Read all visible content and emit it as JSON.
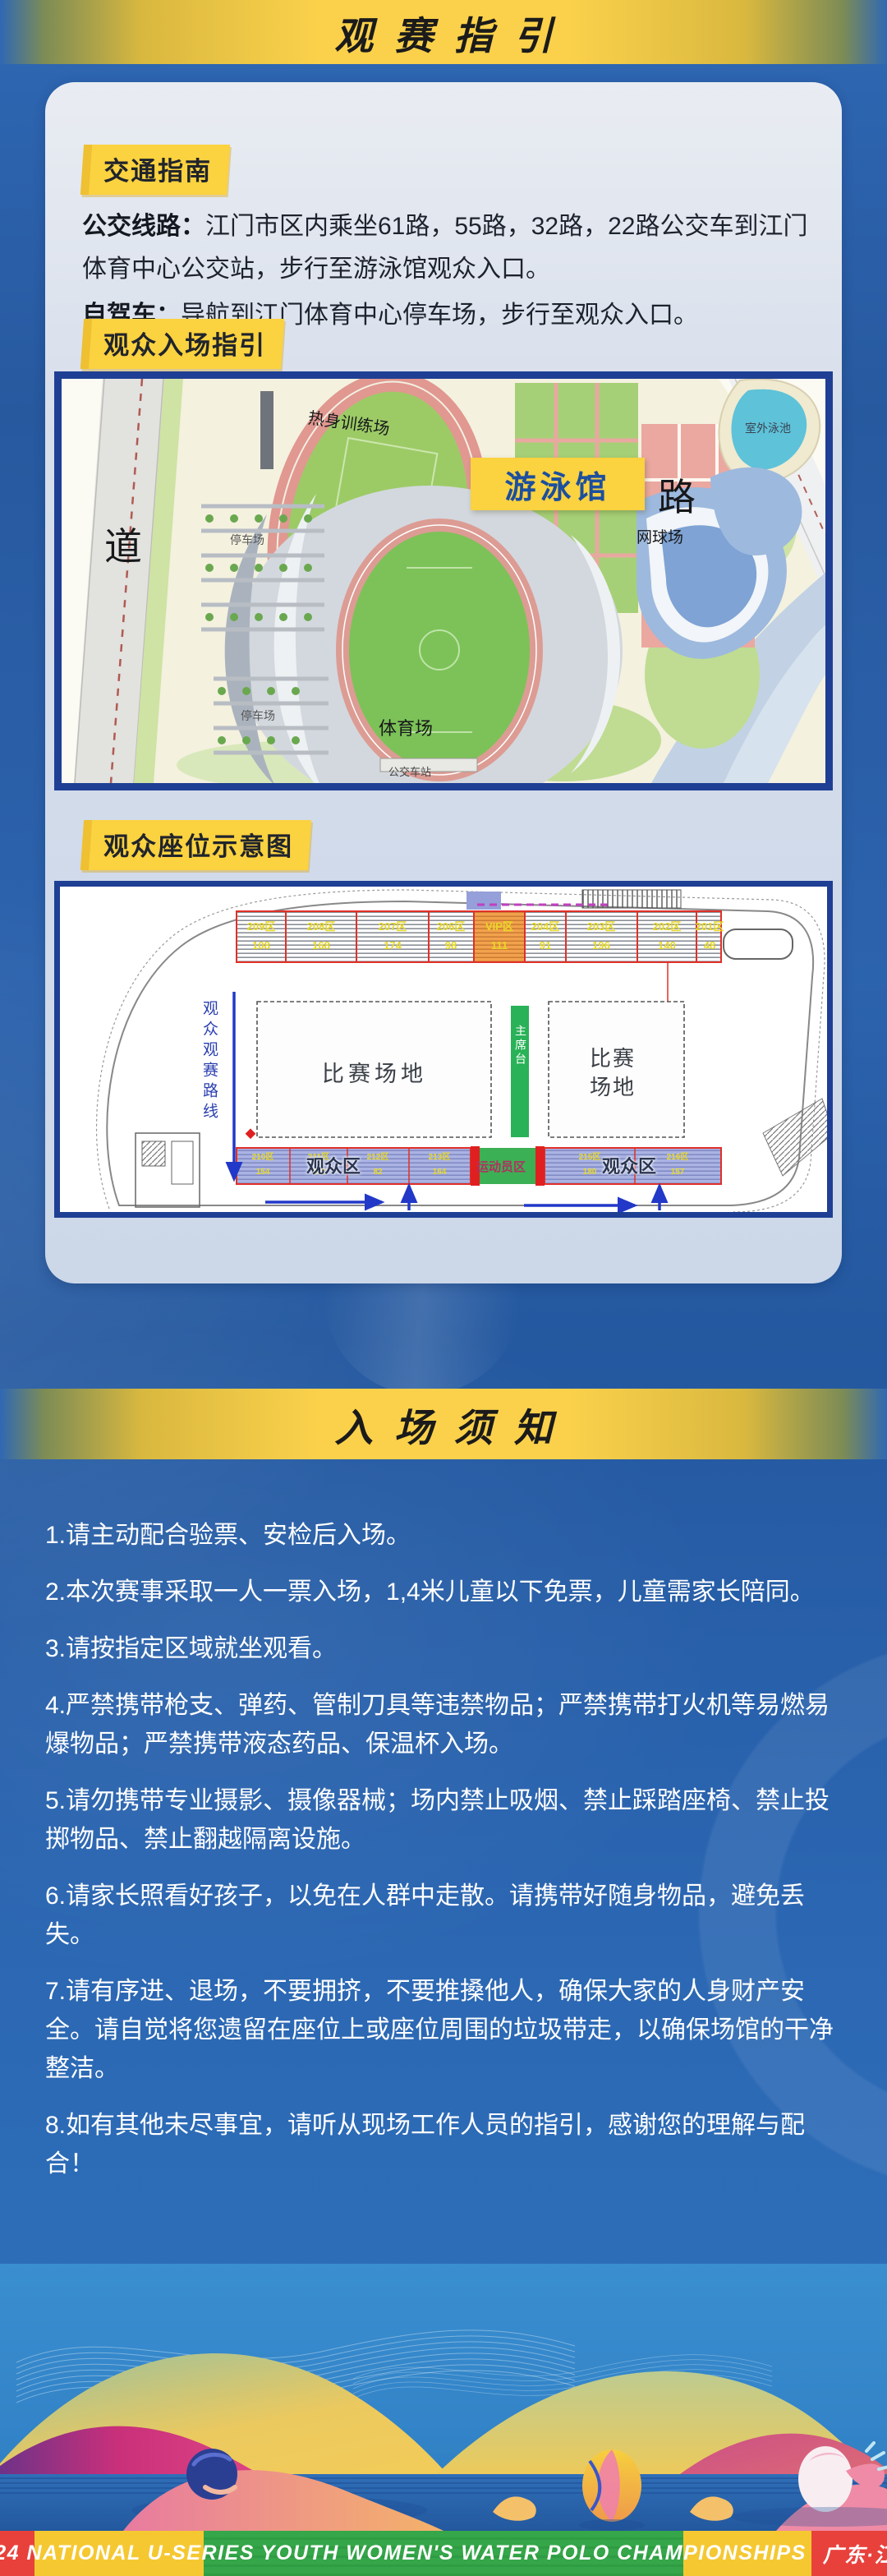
{
  "banner1": {
    "title": "观赛指引"
  },
  "banner2": {
    "title": "入场须知"
  },
  "guide": {
    "traffic_label": "交通指南",
    "bus_label": "公交线路：",
    "bus_text": "江门市区内乘坐61路，55路，32路，22路公交车到江门体育中心公交站，步行至游泳馆观众入口。",
    "drive_label": "自驾车：",
    "drive_text": "导航到江门体育中心停车场，步行至观众入口。",
    "entrance_label": "观众入场指引",
    "seating_label": "观众座位示意图"
  },
  "map": {
    "road_left": "道",
    "road_right": "路",
    "warmup_field": "热身训练场",
    "basketball": "篮球场",
    "tennis": "网球场",
    "outdoor_pool": "室外泳池",
    "natatorium": "游泳馆",
    "stadium": "体育场",
    "parking1": "停车场",
    "parking2": "停车场",
    "bus_station": "公交车站"
  },
  "seating": {
    "route_label": "观众观赛路线",
    "field_label_left": "比赛场地",
    "field_label_right": "比赛场地",
    "rostrum_label": "主席台",
    "audience_left": "观众区",
    "audience_right": "观众区",
    "athlete_label": "运动员区",
    "top_sections": [
      {
        "name": "209区",
        "count": "108"
      },
      {
        "name": "208区",
        "count": "168"
      },
      {
        "name": "207区",
        "count": "174"
      },
      {
        "name": "206区",
        "count": "98"
      },
      {
        "name": "VIP区",
        "count": "111"
      },
      {
        "name": "204区",
        "count": "91"
      },
      {
        "name": "203区",
        "count": "196"
      },
      {
        "name": "202区",
        "count": "140"
      },
      {
        "name": "201区",
        "count": "48"
      }
    ],
    "bottom_left_sections": [
      {
        "name": "210区",
        "count": "154"
      },
      {
        "name": "211区",
        "count": "162"
      },
      {
        "name": "212区",
        "count": "82"
      },
      {
        "name": "213区",
        "count": "164"
      }
    ],
    "bottom_right_sections": [
      {
        "name": "215区",
        "count": "180"
      },
      {
        "name": "216区",
        "count": "157"
      }
    ]
  },
  "rules": [
    "1.请主动配合验票、安检后入场。",
    "2.本次赛事采取一人一票入场，1,4米儿童以下免票，儿童需家长陪同。",
    "3.请按指定区域就坐观看。",
    "4.严禁携带枪支、弹药、管制刀具等违禁物品；严禁携带打火机等易燃易爆物品；严禁携带液态药品、保温杯入场。",
    "5.请勿携带专业摄影、摄像器械；场内禁止吸烟、禁止踩踏座椅、禁止投掷物品、禁止翻越隔离设施。",
    "6.请家长照看好孩子，以免在人群中走散。请携带好随身物品，避免丢失。",
    "7.请有序进、退场，不要拥挤，不要推搡他人，确保大家的人身财产安全。请自觉将您遗留在座位上或座位周围的垃圾带走，以确保场馆的干净整洁。",
    "8.如有其他未尽事宜，请听从现场工作人员的指引，感谢您的理解与配合！"
  ],
  "footer": {
    "text": "2024 NATIONAL U-SERIES YOUTH WOMEN'S WATER POLO CHAMPIONSHIPS",
    "location": "广东·江门"
  },
  "colors": {
    "background_blue": "#2b62ae",
    "band_gold": "#fbd14b",
    "card_bg": "#d6deeb",
    "label_yellow": "#fbd23f",
    "navy_border": "#1e3f94",
    "natatorium_text": "#1d4f9e",
    "footer_red": "#e8413c",
    "footer_yellow": "#f5c832",
    "footer_green": "#35a649"
  }
}
